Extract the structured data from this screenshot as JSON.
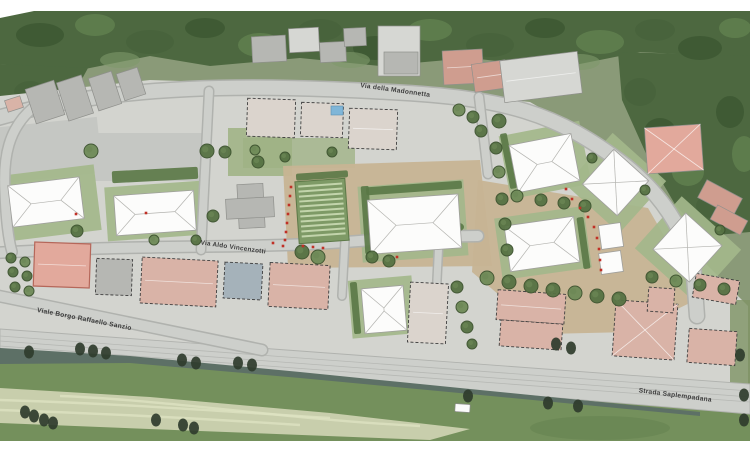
{
  "streets": {
    "madonnetta": "Via della Madonnetta",
    "vincenzotti": "Via Aldo Vincenzotti",
    "sanzio": "Viale Borgo Raffaello Sanzio",
    "padana": "Strada Saplempadana"
  },
  "palette": {
    "base_gray": "#d3d4cf",
    "road": "#cdcfcb",
    "road_casing": "#b0b2ae",
    "forest": "#4d6840",
    "forest_dark": "#3d5833",
    "forest_light": "#60804f",
    "field_green": "#74905c",
    "dry_grass": "#ccd2b0",
    "canal": "#5d7066",
    "lawn": "#a3b78b",
    "lawn_light": "#9db183",
    "plaza_tan": "#c7b493",
    "hedge": "#5a7846",
    "tree": "#567243",
    "tree_rim": "#3d532f",
    "dark_tree": "#2f3c2c",
    "white_roof": "#fcfcfb",
    "roof_line": "#b3b3af",
    "gray_roof": "#b6b7b3",
    "light_roof": "#d6d7d3",
    "pale_roof": "#dbd4cd",
    "terracotta": "#cf9d8f",
    "salmon": "#e2a99c",
    "pink_roof": "#d9b3a7",
    "blue_roof": "#a5b2ba",
    "pool_blue": "#7fb6d8",
    "red_marker": "#c03026",
    "margin_white": "#ffffff"
  }
}
